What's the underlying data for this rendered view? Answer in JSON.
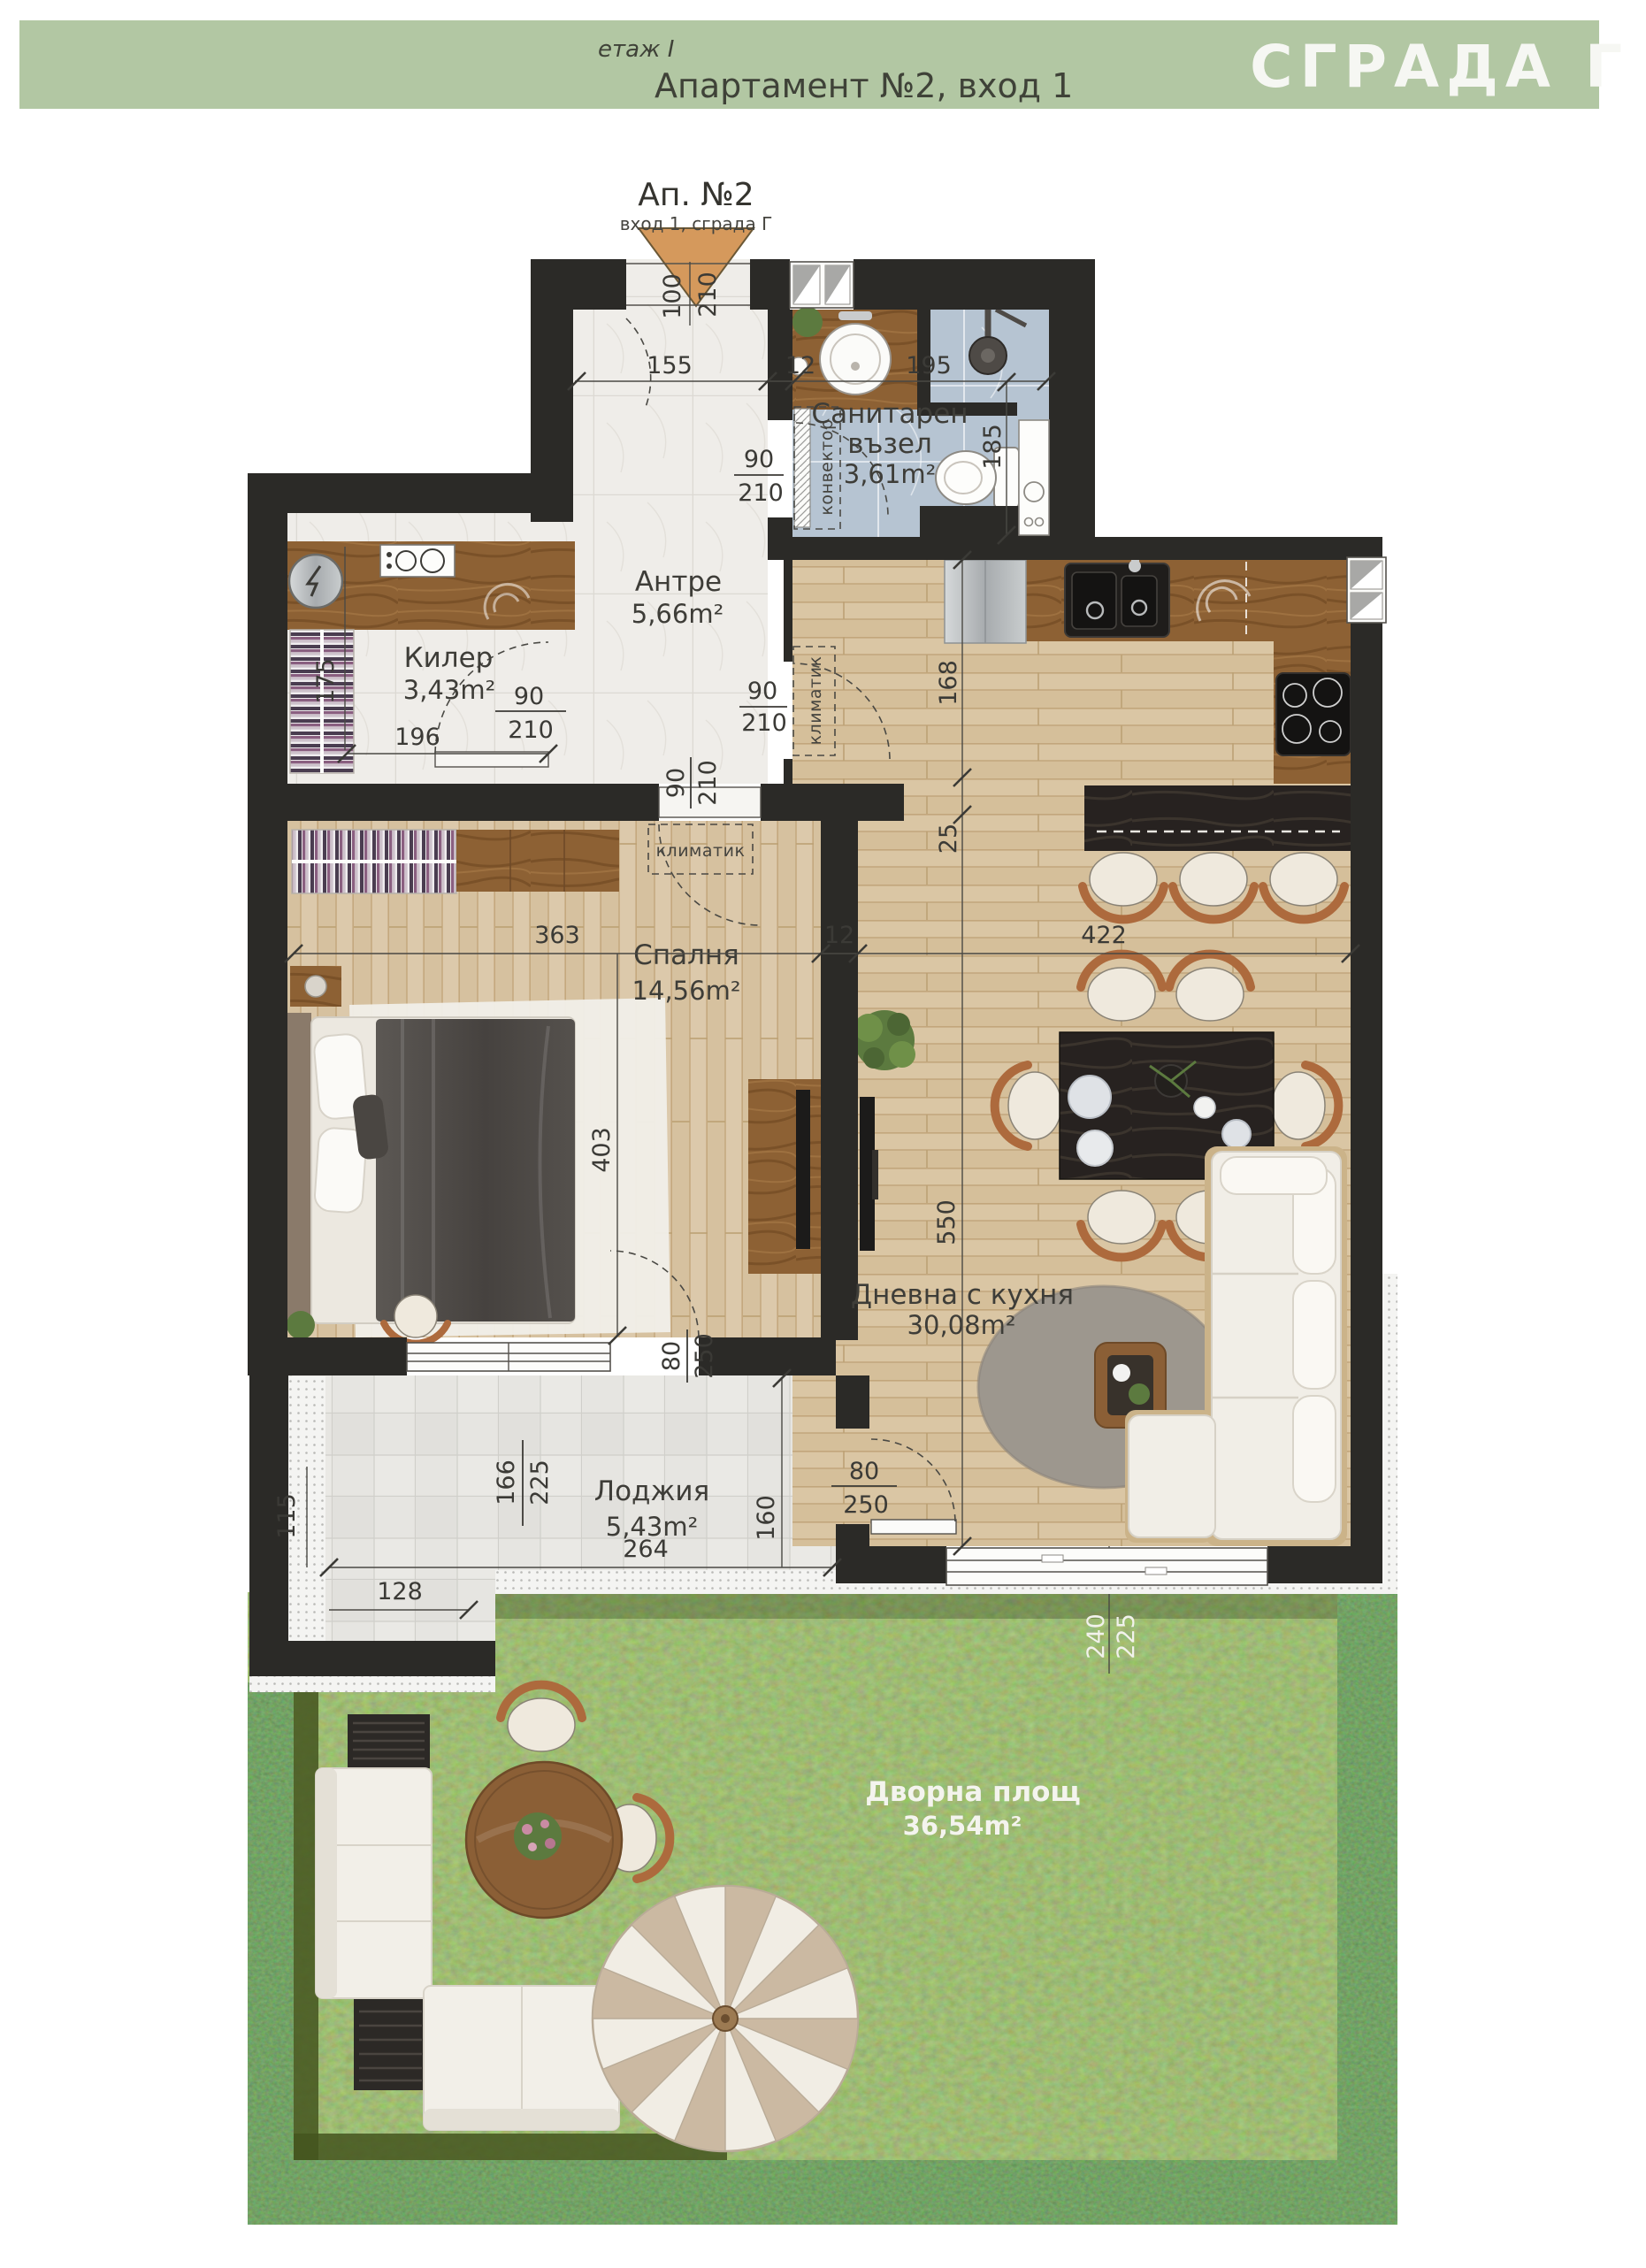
{
  "header": {
    "floor": "етаж I",
    "title": "Апартамент №2, вход 1",
    "building": "СГРАДА Г"
  },
  "plan": {
    "apartment": "Ап. №2",
    "entrance": "вход 1, сграда Г"
  },
  "rooms": {
    "entry": {
      "name": "Антре",
      "area": "5,66m²"
    },
    "bath": {
      "name1": "Санитарен",
      "name2": "възел",
      "area": "3,61m²"
    },
    "storage": {
      "name": "Килер",
      "area": "3,43m²"
    },
    "bedroom": {
      "name": "Спалня",
      "area": "14,56m²"
    },
    "living": {
      "name": "Дневна с кухня",
      "area": "30,08m²"
    },
    "loggia": {
      "name": "Лоджия",
      "area": "5,43m²"
    },
    "yard": {
      "name": "Дворна площ",
      "area": "36,54m²"
    }
  },
  "labels": {
    "convector": "конвектор",
    "ac_hall": "климатик",
    "ac_bedroom": "климатик"
  },
  "dims": {
    "entry_door": {
      "w": "100",
      "h": "210"
    },
    "entry_width": "155",
    "gap12": "12",
    "bath_width": "195",
    "bath_depth": "185",
    "bath_door": {
      "w": "90",
      "h": "210"
    },
    "storage_depth": "175",
    "storage_door": {
      "w": "90",
      "h": "210"
    },
    "storage_width": "196",
    "hall_door": {
      "w": "90",
      "h": "210"
    },
    "bedroom_door": {
      "w": "90",
      "h": "210"
    },
    "kitchen_wall": "168",
    "wall_thickness": "25",
    "bedroom_width": "363",
    "wall12": "12",
    "living_width": "422",
    "bedroom_depth": "403",
    "living_depth": "550",
    "bedroom_terrace_door": {
      "w": "80",
      "h": "250"
    },
    "loggia_side": "115",
    "loggia_notch": "128",
    "loggia_window": {
      "w": "166",
      "h": "225"
    },
    "loggia_depth": "160",
    "living_terrace_door": {
      "w": "80",
      "h": "250"
    },
    "loggia_width": "264",
    "yard_opening": {
      "w": "240",
      "h": "225"
    }
  },
  "colors": {
    "header_green": "#b2c7a3",
    "badge_text": "#f6f7f3",
    "wall": "#2b2a27",
    "marble": "#efede9",
    "bath_tile": "#b6c4d2",
    "wood_floor": "#dac6a4",
    "counter_wood": "#8d6134",
    "bar_wood": "#272220",
    "loggia_tile": "#e6e5e1",
    "grass": "#70904e",
    "hedge": "#47651f",
    "accent_door": "#d5995c",
    "dim_text": "#3b3a36"
  }
}
